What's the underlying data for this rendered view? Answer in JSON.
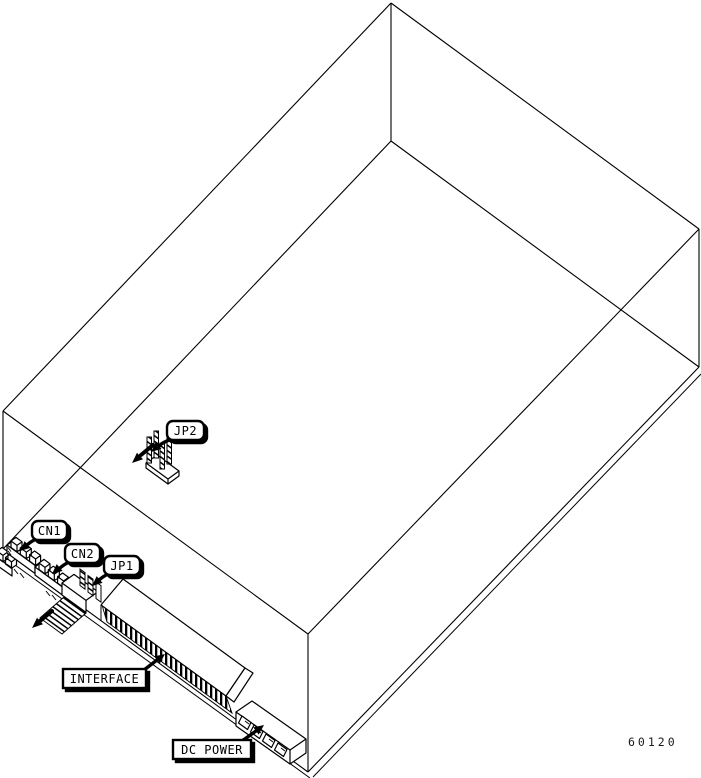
{
  "diagram": {
    "type": "isometric-line-art",
    "labels": {
      "jp2": "JP2",
      "cn1": "CN1",
      "cn2": "CN2",
      "jp1": "JP1",
      "interface": "INTERFACE",
      "dc_power": "DC POWER"
    },
    "figure_number": "60120",
    "colors": {
      "line": "#000000",
      "background": "#ffffff"
    }
  }
}
